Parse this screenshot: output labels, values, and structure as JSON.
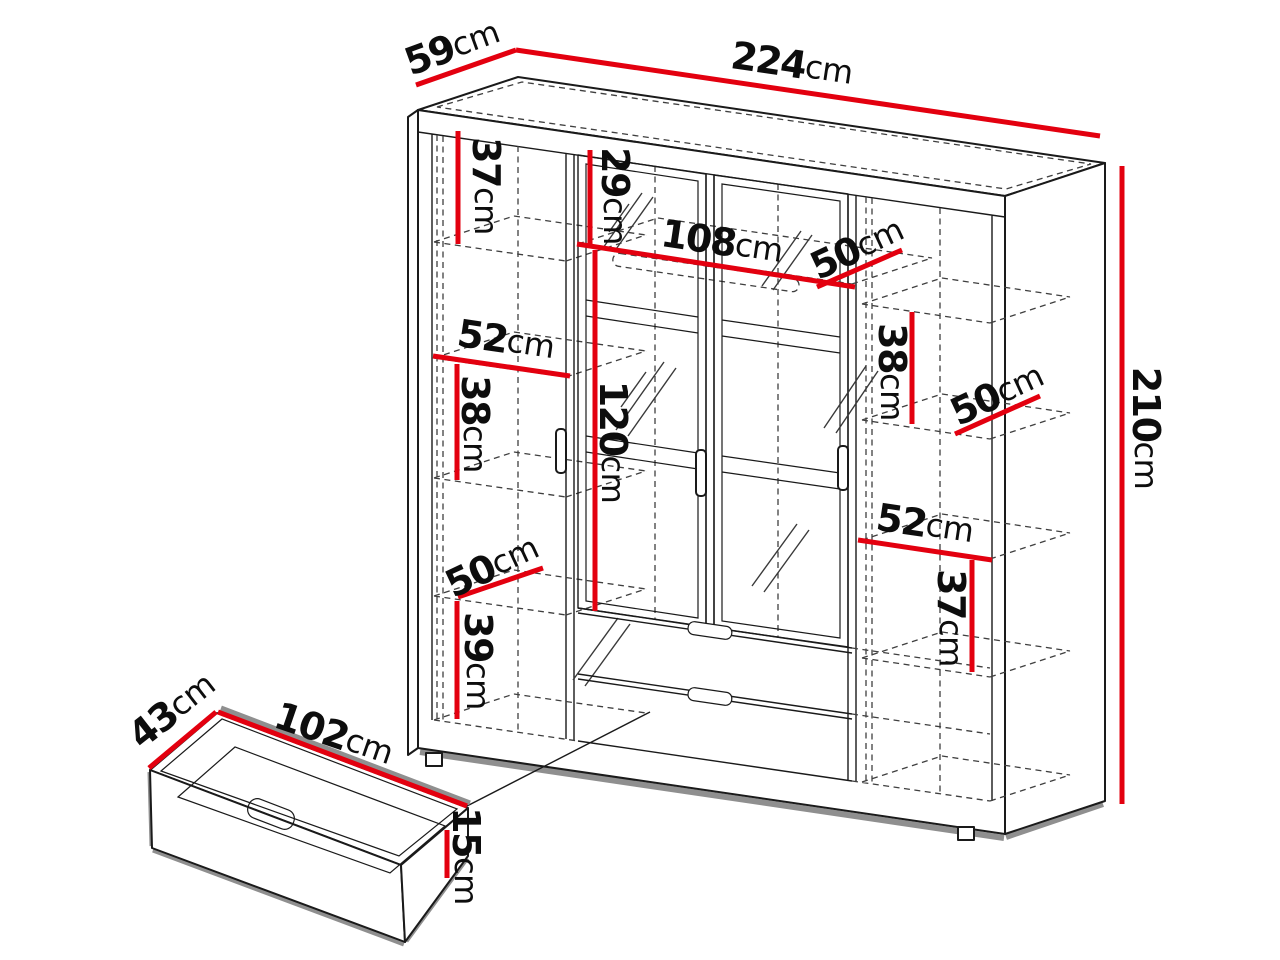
{
  "diagram": {
    "name": "wardrobe-dimensions-diagram",
    "unit": "cm"
  },
  "colors": {
    "accent": "#e3000f",
    "outline": "#1a1a1a",
    "dash": "#3f3f3f",
    "shadow": "#8f8f8f",
    "background": "#ffffff"
  },
  "dims": {
    "width": {
      "value": "224",
      "unit": "cm"
    },
    "depth": {
      "value": "59",
      "unit": "cm"
    },
    "height": {
      "value": "210",
      "unit": "cm"
    },
    "left_top_section": {
      "value": "37",
      "unit": "cm"
    },
    "left_shelf_width": {
      "value": "52",
      "unit": "cm"
    },
    "left_mid_section": {
      "value": "38",
      "unit": "cm"
    },
    "left_shelf_depth": {
      "value": "50",
      "unit": "cm"
    },
    "left_bottom_section": {
      "value": "39",
      "unit": "cm"
    },
    "center_top_section": {
      "value": "29",
      "unit": "cm"
    },
    "center_width": {
      "value": "108",
      "unit": "cm"
    },
    "center_door_height": {
      "value": "120",
      "unit": "cm"
    },
    "right_top_depth": {
      "value": "50",
      "unit": "cm"
    },
    "right_top_section": {
      "value": "38",
      "unit": "cm"
    },
    "right_mid_depth": {
      "value": "50",
      "unit": "cm"
    },
    "right_shelf_width": {
      "value": "52",
      "unit": "cm"
    },
    "right_bottom_section": {
      "value": "37",
      "unit": "cm"
    },
    "drawer_width": {
      "value": "102",
      "unit": "cm"
    },
    "drawer_depth": {
      "value": "43",
      "unit": "cm"
    },
    "drawer_height": {
      "value": "15",
      "unit": "cm"
    }
  }
}
